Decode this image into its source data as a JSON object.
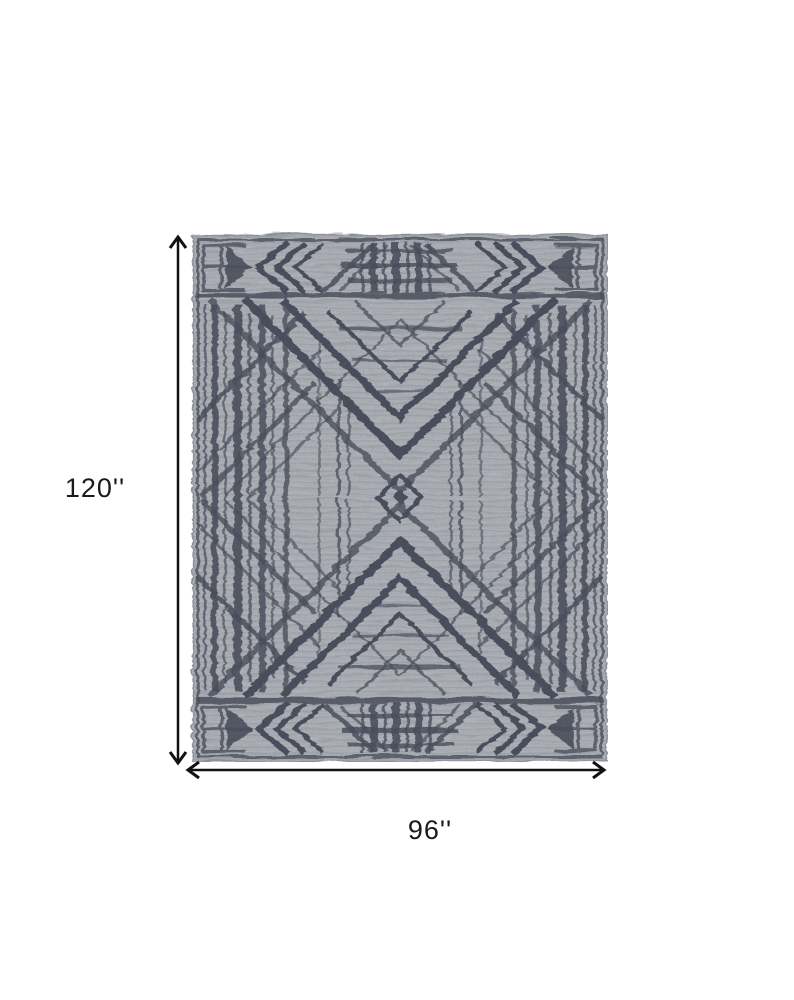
{
  "figure": {
    "type": "product-dimension-diagram",
    "background_color": "#ffffff",
    "annotation_color": "#1a1a1a"
  },
  "rug": {
    "description": "Gray and dark slate art deco geometric patterned area rug shown flat",
    "ground_color": "#a9adb3",
    "pattern_color": "#3e4351"
  },
  "dimensions": {
    "height": {
      "label": "120''",
      "value": 120
    },
    "width": {
      "label": "96''",
      "value": 96
    }
  }
}
